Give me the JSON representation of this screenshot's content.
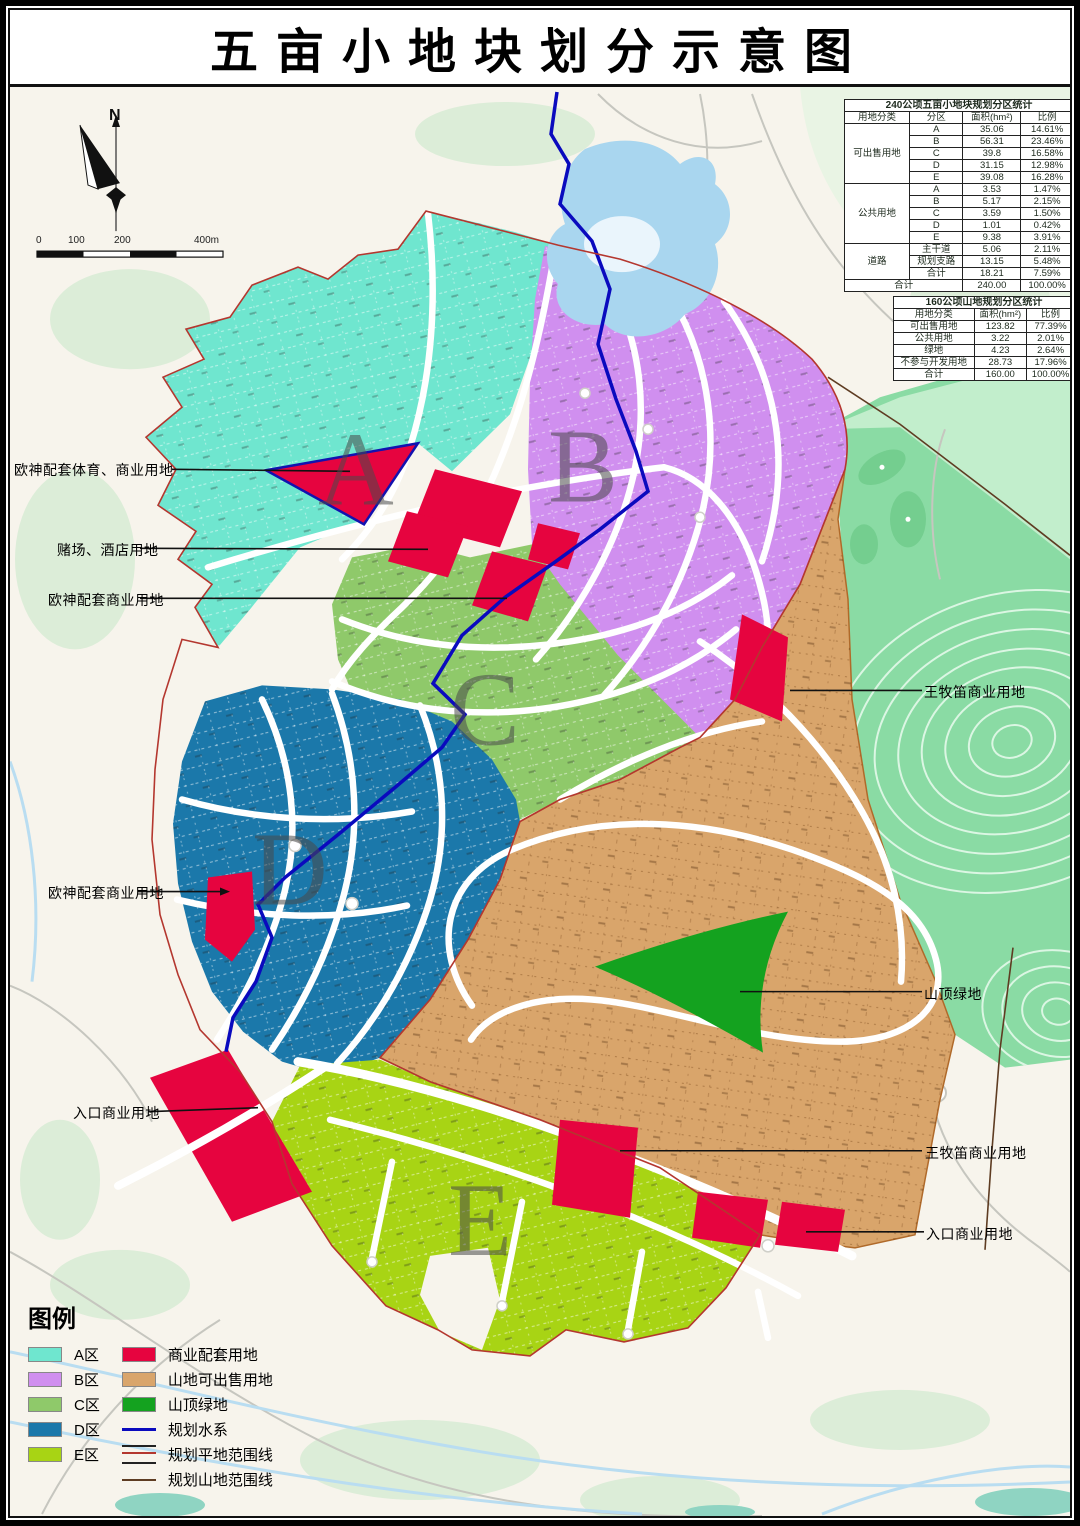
{
  "title": "五亩小地块划分示意图",
  "north_label": "N",
  "scale": {
    "ticks": [
      "0",
      "100",
      "200",
      "400m"
    ]
  },
  "zones": {
    "a": "A",
    "b": "B",
    "c": "C",
    "d": "D",
    "e": "E"
  },
  "table1": {
    "title": "240公顷五亩小地块规划分区统计",
    "headers": [
      "用地分类",
      "分区",
      "面积(hm²)",
      "比例"
    ],
    "groups": [
      {
        "category": "可出售用地",
        "rows": [
          [
            "A",
            "35.06",
            "14.61%"
          ],
          [
            "B",
            "56.31",
            "23.46%"
          ],
          [
            "C",
            "39.8",
            "16.58%"
          ],
          [
            "D",
            "31.15",
            "12.98%"
          ],
          [
            "E",
            "39.08",
            "16.28%"
          ]
        ]
      },
      {
        "category": "公共用地",
        "rows": [
          [
            "A",
            "3.53",
            "1.47%"
          ],
          [
            "B",
            "5.17",
            "2.15%"
          ],
          [
            "C",
            "3.59",
            "1.50%"
          ],
          [
            "D",
            "1.01",
            "0.42%"
          ],
          [
            "E",
            "9.38",
            "3.91%"
          ]
        ]
      },
      {
        "category": "道路",
        "rows": [
          [
            "主干道",
            "5.06",
            "2.11%"
          ],
          [
            "规划支路",
            "13.15",
            "5.48%"
          ],
          [
            "合计",
            "18.21",
            "7.59%"
          ]
        ]
      }
    ],
    "total_label": "合计",
    "total_area": "240.00",
    "total_pct": "100.00%"
  },
  "table2": {
    "title": "160公顷山地规划分区统计",
    "headers": [
      "用地分类",
      "面积(hm²)",
      "比例"
    ],
    "rows": [
      [
        "可出售用地",
        "123.82",
        "77.39%"
      ],
      [
        "公共用地",
        "3.22",
        "2.01%"
      ],
      [
        "绿地",
        "4.23",
        "2.64%"
      ],
      [
        "不参与开发用地",
        "28.73",
        "17.96%"
      ],
      [
        "合计",
        "160.00",
        "100.00%"
      ]
    ]
  },
  "callouts": {
    "left": [
      {
        "label": "欧神配套体育、商业用地"
      },
      {
        "label": "赌场、酒店用地"
      },
      {
        "label": "欧神配套商业用地"
      },
      {
        "label": "欧神配套商业用地"
      },
      {
        "label": "入口商业用地"
      }
    ],
    "right": [
      {
        "label": "王牧笛商业用地"
      },
      {
        "label": "山顶绿地"
      },
      {
        "label": "王牧笛商业用地"
      },
      {
        "label": "入口商业用地"
      }
    ]
  },
  "legend": {
    "heading": "图例",
    "items_left": [
      {
        "label": "A区",
        "color": "#6FE6CF"
      },
      {
        "label": "B区",
        "color": "#D08FEF"
      },
      {
        "label": "C区",
        "color": "#8FC96A"
      },
      {
        "label": "D区",
        "color": "#1B78AA"
      },
      {
        "label": "E区",
        "color": "#A8D414"
      }
    ],
    "items_right": [
      {
        "label": "商业配套用地",
        "color": "#E6043F"
      },
      {
        "label": "山地可出售用地",
        "color": "#D9A56B"
      },
      {
        "label": "山顶绿地",
        "color": "#14A21F"
      },
      {
        "label": "规划水系",
        "color": "#0A0ABE"
      },
      {
        "label": "规划平地范围线",
        "color": "#B4372F"
      },
      {
        "label": "规划山地范围线",
        "color": "#5E3C22"
      }
    ]
  },
  "colors": {
    "background": "#F7F4EC",
    "river": "#0A0ABE",
    "lake": "#A9D6EF",
    "mountain_green": "#8ADBA4",
    "roads": "#FFFFFF",
    "flat_boundary": "#B4372F",
    "mountain_boundary": "#5E3C22"
  }
}
